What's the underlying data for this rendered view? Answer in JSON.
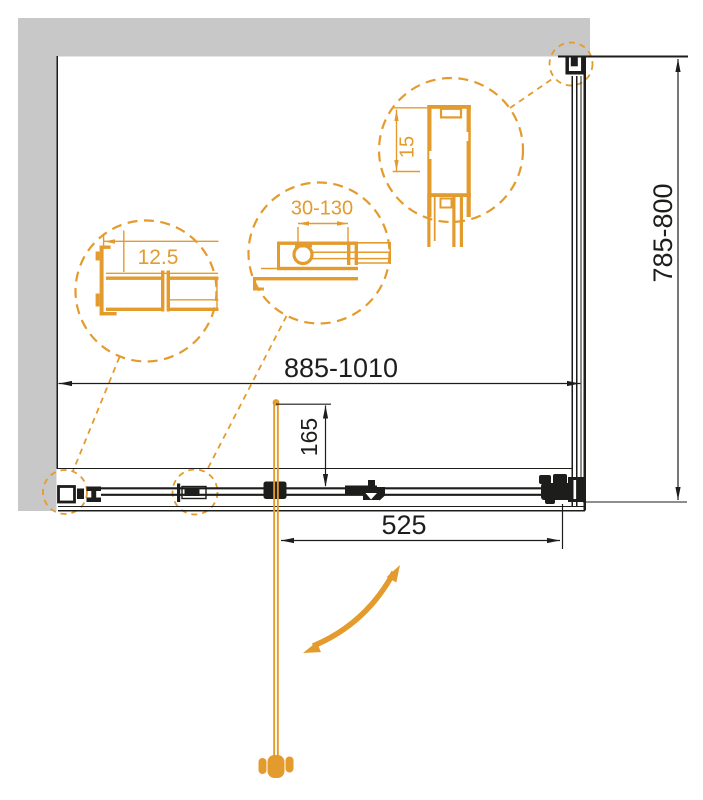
{
  "drawing": {
    "type": "shower-enclosure-technical-plan-view",
    "colors": {
      "accent_orange": "#e49b2d",
      "line_black": "#1d1d1b",
      "wall_gray": "#c8c8c8",
      "background": "#ffffff"
    },
    "dimensions": {
      "width_range": "885-1010",
      "depth_range": "785-800",
      "door_width": "525",
      "pivot_offset": "165",
      "profile_overlap": "12.5",
      "adjustment_range": "30-130",
      "glass_inset": "15"
    }
  }
}
